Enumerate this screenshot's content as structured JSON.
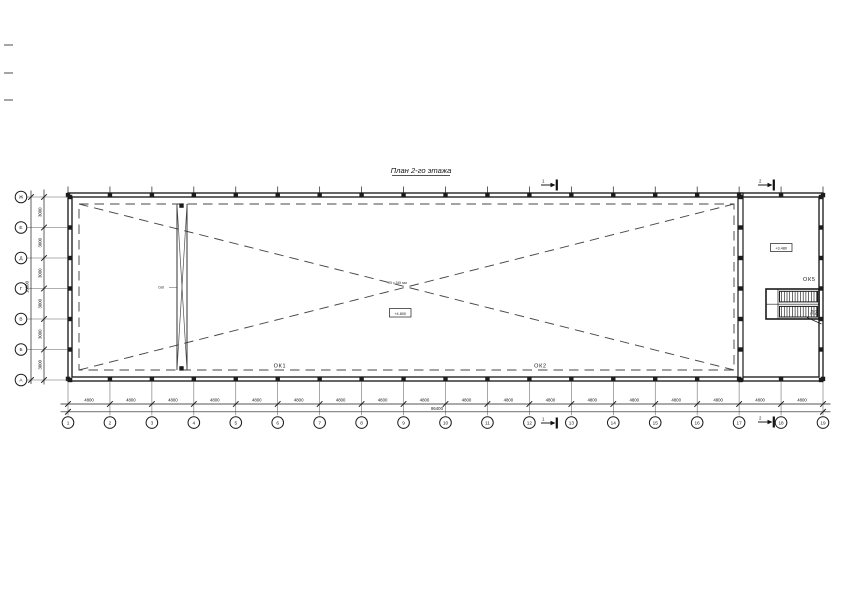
{
  "title": "План 2-го этажа",
  "drawing": {
    "grid": {
      "cols": [
        "1",
        "2",
        "3",
        "4",
        "5",
        "6",
        "7",
        "8",
        "9",
        "10",
        "11",
        "12",
        "13",
        "14",
        "15",
        "16",
        "17",
        "18",
        "19"
      ],
      "rows": [
        "Ж",
        "Е",
        "Д",
        "Г",
        "В",
        "Б",
        "А"
      ]
    },
    "dimensions": {
      "col_bays": [
        "4800",
        "4800",
        "4800",
        "4800",
        "4800",
        "4800",
        "4800",
        "4800",
        "4800",
        "4800",
        "4800",
        "4800",
        "4800",
        "4800",
        "4800",
        "4800",
        "4800",
        "4800"
      ],
      "col_total": "86400",
      "row_bays": [
        "3000",
        "3000",
        "3000",
        "3000",
        "3000",
        "3000"
      ],
      "row_total": "18000"
    },
    "labels": {
      "window_mark_1": "ОК1",
      "window_mark_2": "ОК2",
      "window_mark_5": "ОК5",
      "stair_mark": "Л2",
      "brace_mark": "Св8",
      "center_note": "25 х 345 мм",
      "center_level": "+4.800",
      "right_level": "+3.480"
    },
    "sections": {
      "s1": "1",
      "s2": "2"
    },
    "colors": {
      "line": "#1c1c1c",
      "dashed": "#474747",
      "background": "#ffffff"
    }
  }
}
